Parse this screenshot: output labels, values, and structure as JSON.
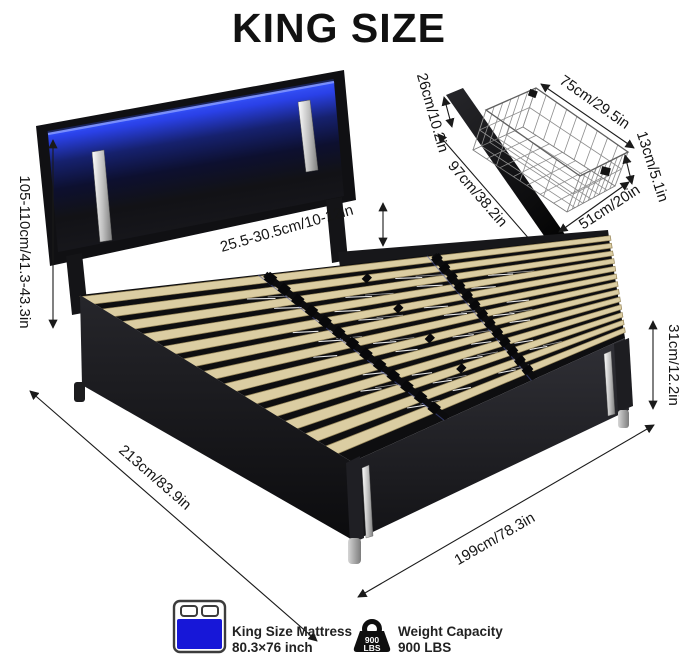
{
  "title": "KING SIZE",
  "bed_diagram": {
    "dimensions": {
      "total_height": "105-110cm/41.3-43.3in",
      "headboard_clearance": "25.5-30.5cm/10-12in",
      "length": "213cm/83.9in",
      "width": "199cm/78.3in",
      "base_height": "31cm/12.2in"
    }
  },
  "drawer_diagram": {
    "dimensions": {
      "panel_height": "26cm/10.2in",
      "panel_length": "97cm/38.2in",
      "basket_length": "75cm/29.5in",
      "basket_height": "13cm/5.1in",
      "basket_width": "51cm/20in"
    }
  },
  "legend": {
    "mattress": {
      "icon": "mattress-icon",
      "label": "King Size Mattress",
      "value": "80.3×76 inch"
    },
    "weight": {
      "icon": "weight-icon",
      "label": "Weight Capacity",
      "value": "900 LBS",
      "badge_top": "900",
      "badge_bottom": "LBS"
    }
  },
  "colors": {
    "led_blue": "#2e4bfa",
    "mattress_blue": "#1717d8",
    "upholstery_black": "#17171a",
    "slat_wood": "#dbcda2",
    "chrome": "#d9d9d9",
    "dimension_ink": "#151515"
  }
}
